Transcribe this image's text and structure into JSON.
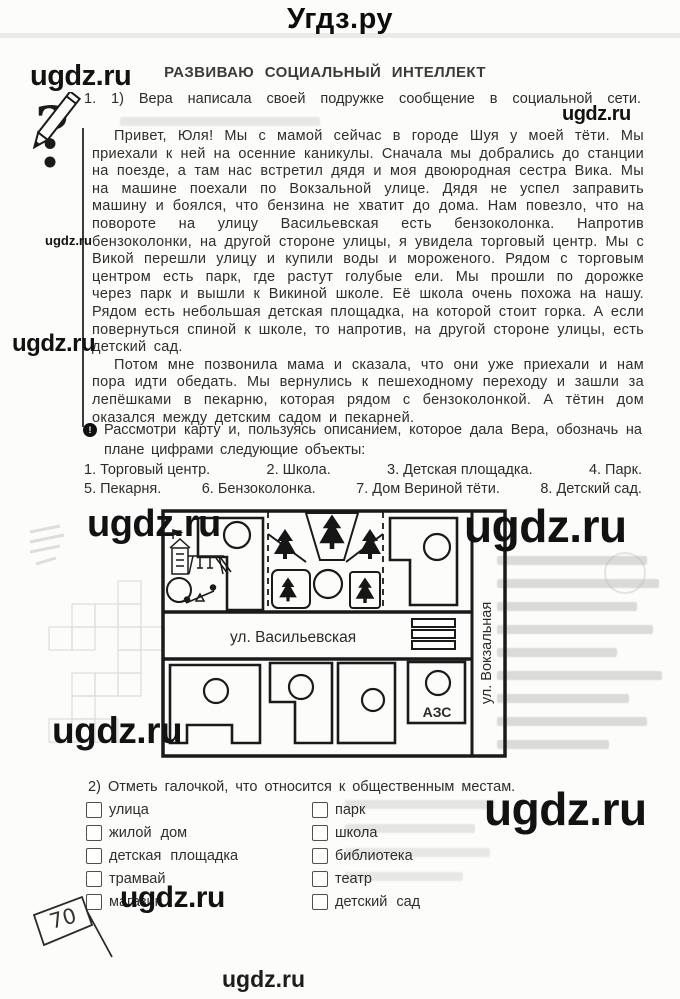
{
  "page": {
    "header_site": "Угдз.ру",
    "footer_site": "ugdz.ru",
    "watermark": "ugdz.ru",
    "page_number": "70"
  },
  "lesson": {
    "title": "РАЗВИВАЮ  СОЦИАЛЬНЫЙ  ИНТЕЛЛЕКТ",
    "task1": {
      "number": "1.",
      "part": "1)",
      "intro": "Вера написала своей подружке сообщение в социальной сети.",
      "message": {
        "p1": "Привет, Юля! Мы с мамой сейчас в городе Шуя у моей тёти. Мы приехали к ней на осенние каникулы. Сначала мы добрались до станции на поезде, а там нас встретил дядя и моя двоюродная сестра Вика. Мы на машине поехали по Вокзальной улице. Дядя не успел заправить машину и боялся, что бензина не хватит до дома. Нам повезло, что на повороте на улицу Васильевская есть бензоколонка. Напротив бензоколонки, на другой стороне улицы, я увидела торговый центр. Мы с Викой перешли улицу и купили воды и мороженого. Рядом с торговым центром есть парк, где растут голубые ели. Мы прошли по дорожке через парк и вышли к Викиной школе. Её школа очень похожа на нашу. Рядом есть небольшая детская площадка, на которой стоит горка. А если повернуться спиной к школе, то напротив, на другой стороне улицы, есть детский сад.",
        "p2": "Потом мне позвонила мама и сказала, что они уже приехали и нам пора идти обедать. Мы вернулись к пешеходному переходу и зашли за лепёшками в пекарню, которая рядом с бензоколонкой. А тётин дом оказался между детским садом и пекарней."
      }
    },
    "map_task": {
      "instruction": "Рассмотри карту и, пользуясь описанием, которое дала Вера, обозначь на плане цифрами следующие объекты:",
      "objects": [
        "1.  Торговый  центр.",
        "2.  Школа.",
        "3.  Детская  площадка.",
        "4.  Парк.",
        "5.  Пекарня.",
        "6.  Бензоколонка.",
        "7.  Дом  Вериной  тёти.",
        "8.  Детский  сад."
      ]
    },
    "map": {
      "street_horizontal": "ул.  Васильевская",
      "street_vertical": "ул.  Вокзальная",
      "gas_station_label": "АЗС"
    },
    "task2": {
      "number": "2)",
      "instruction": "Отметь галочкой, что относится к общественным местам.",
      "left_options": [
        "улица",
        "жилой  дом",
        "детская  площадка",
        "трамвай",
        "магазин"
      ],
      "right_options": [
        "парк",
        "школа",
        "библиотека",
        "театр",
        "детский  сад"
      ]
    }
  }
}
